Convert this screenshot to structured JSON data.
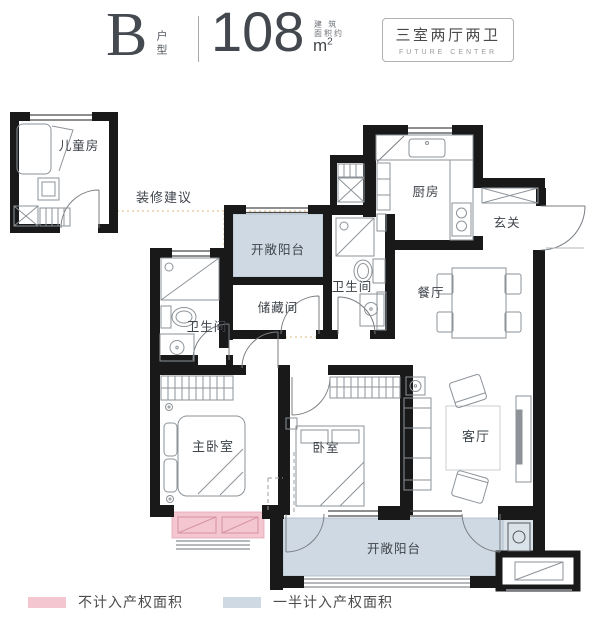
{
  "header": {
    "unit_letter": "B",
    "unit_label": "户型",
    "area_value": "108",
    "area_note_line1": "建 筑",
    "area_note_line2": "面积约",
    "area_unit_base": "m",
    "area_unit_sup": "2",
    "badge_title": "三室两厅两卫",
    "badge_subtitle": "FUTURE CENTER"
  },
  "plan": {
    "annotation_label": "装修建议",
    "rooms": {
      "children_room": "儿童房",
      "kitchen": "厨房",
      "foyer": "玄关",
      "balcony_top": "开敞阳台",
      "bathroom_right": "卫生间",
      "storage": "储藏间",
      "dining": "餐厅",
      "bathroom_left": "卫生间",
      "master_bedroom": "主卧室",
      "bedroom": "卧室",
      "living_room": "客厅",
      "balcony_bottom": "开敞阳台"
    }
  },
  "legend": {
    "items": [
      {
        "label": "不计入产权面积",
        "color": "#f3c6d0"
      },
      {
        "label": "一半计入产权面积",
        "color": "#cfd9e3"
      }
    ]
  },
  "colors": {
    "wall": "#191919",
    "balcony_fill": "#cfd9e3",
    "balcony_stroke": "#a9bac9",
    "excluded_fill": "#f3c6d0",
    "excluded_stroke": "#e3a7b6",
    "suggestion_dotted": "#e4c59b"
  }
}
